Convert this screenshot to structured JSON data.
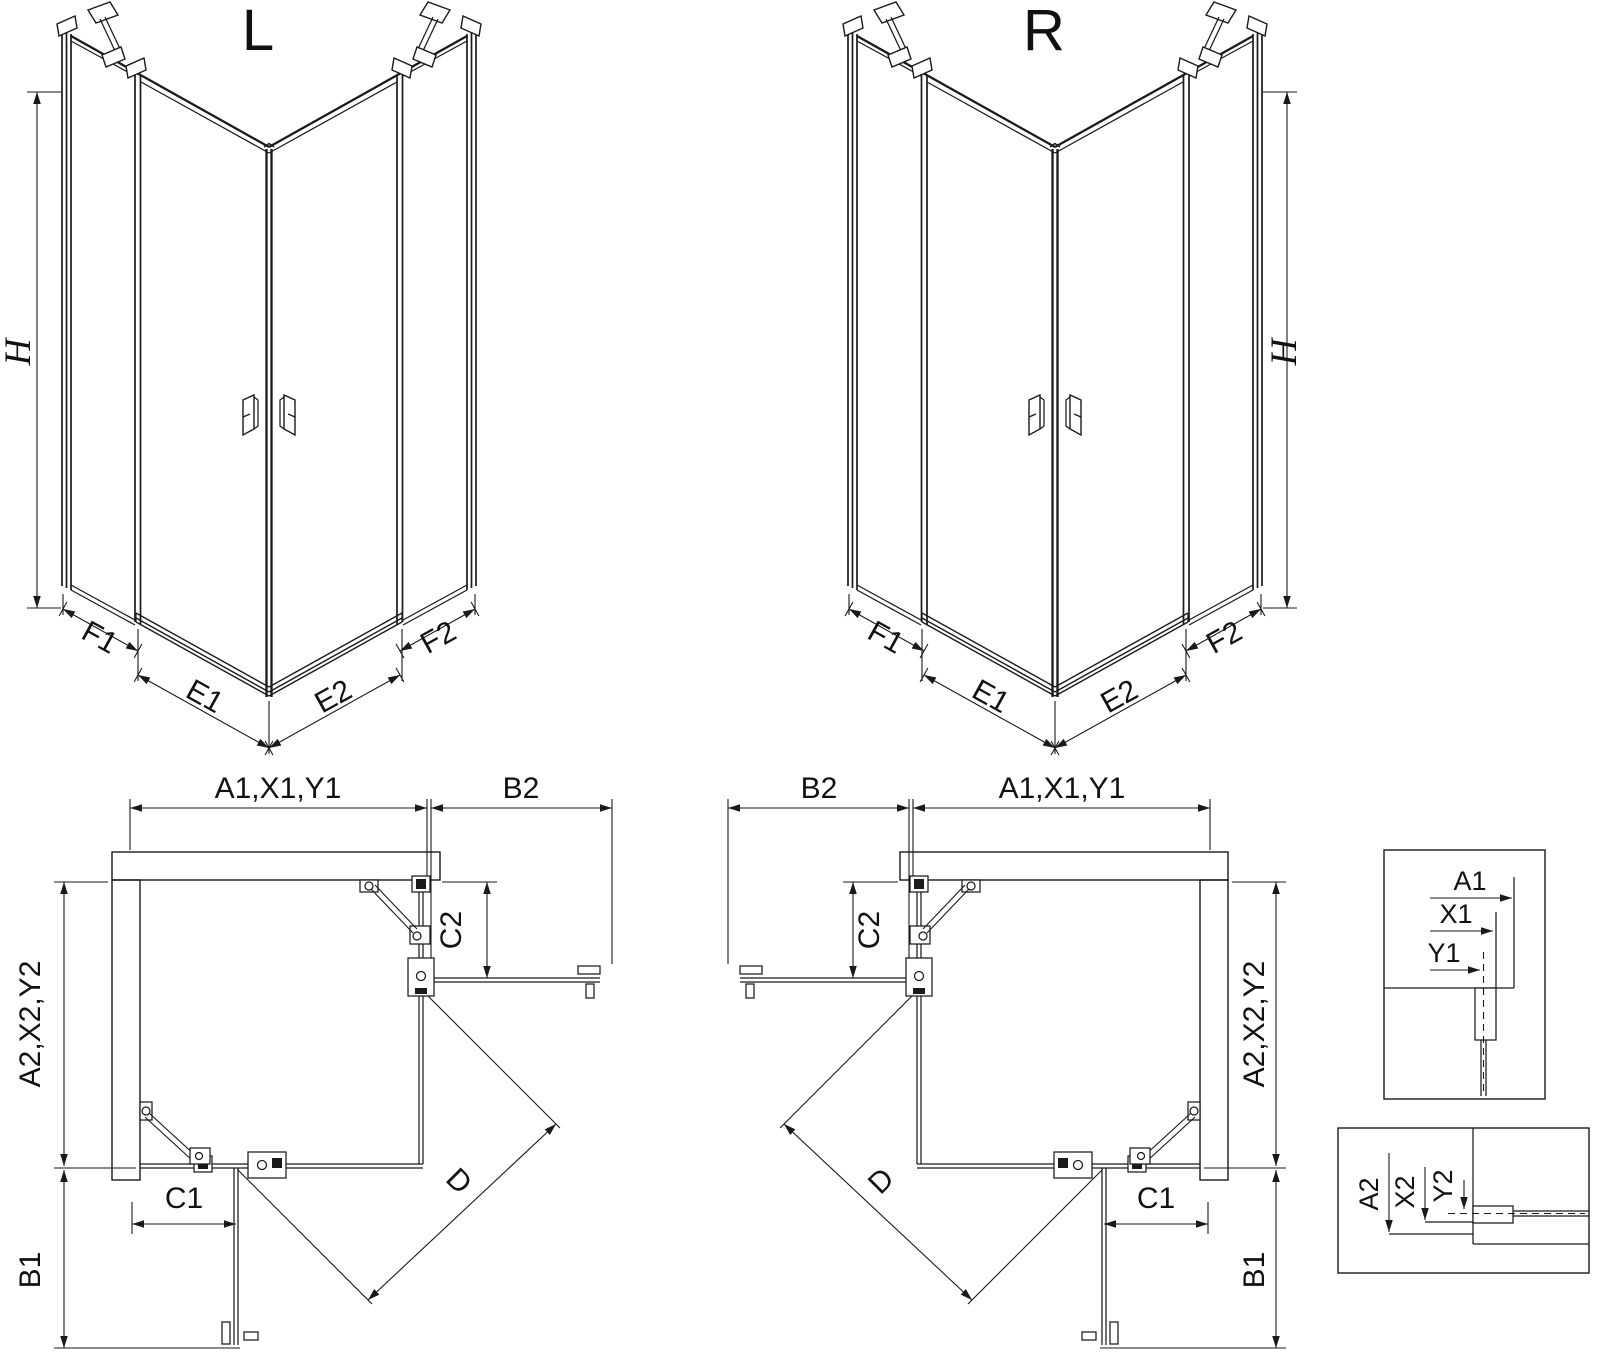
{
  "drawing": {
    "colors": {
      "line": "#1a1a1a",
      "background": "#ffffff"
    },
    "iso_left": {
      "title": "L",
      "height_label": "H",
      "bottom_labels": {
        "fixed_near": "F1",
        "door_near": "E1",
        "door_far": "E2",
        "fixed_far": "F2"
      }
    },
    "iso_right": {
      "title": "R",
      "height_label": "H",
      "bottom_labels": {
        "fixed_near": "F2",
        "door_near": "E2",
        "door_far": "E1",
        "fixed_far": "F1"
      }
    },
    "plan_left": {
      "width_label": "A1,X1,Y1",
      "return_top_label": "B2",
      "fixed_top_label": "C2",
      "depth_label": "A2,X2,Y2",
      "fixed_side_label": "C1",
      "return_side_label": "B1",
      "diagonal_label": "D"
    },
    "plan_right": {
      "width_label": "A1,X1,Y1",
      "return_top_label": "B2",
      "fixed_top_label": "C2",
      "depth_label": "A2,X2,Y2",
      "fixed_side_label": "C1",
      "return_side_label": "B1",
      "diagonal_label": "D"
    },
    "detail_width": {
      "labels": [
        "A1",
        "X1",
        "Y1"
      ]
    },
    "detail_depth": {
      "labels": [
        "A2",
        "X2",
        "Y2"
      ]
    }
  }
}
